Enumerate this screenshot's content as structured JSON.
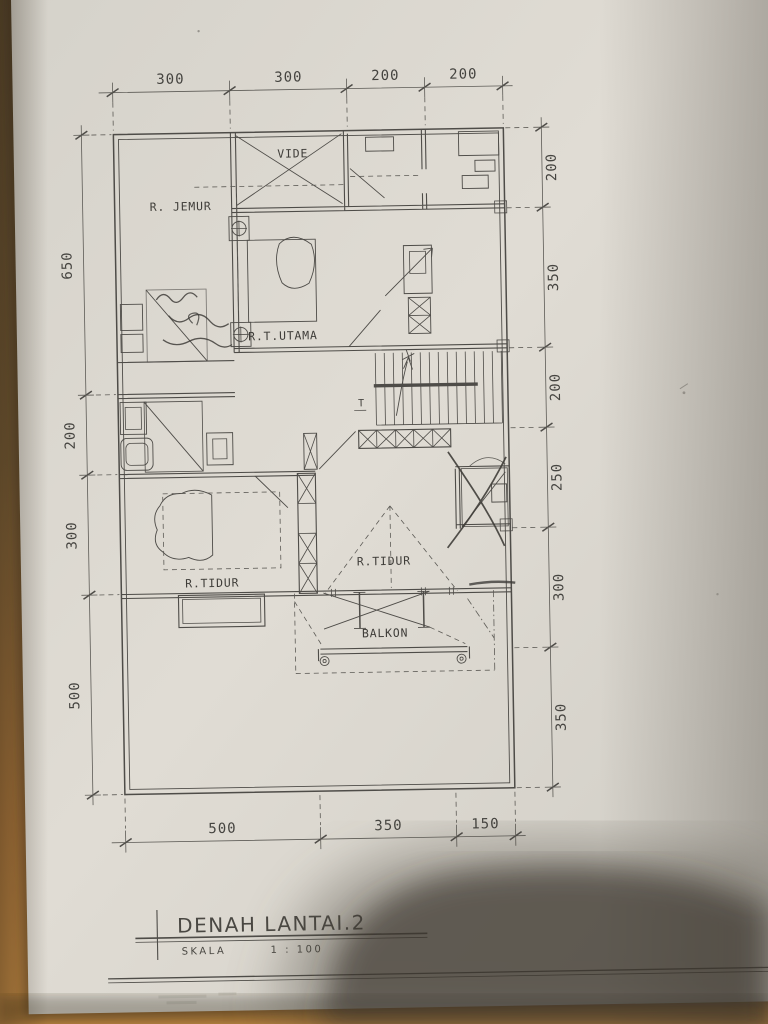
{
  "sheet": {
    "title": "DENAH LANTAI.2",
    "scale_label": "SKALA",
    "scale_value": "1 : 100"
  },
  "rooms": {
    "jemur": "R. JEMUR",
    "vide": "VIDE",
    "utama": "R.T.UTAMA",
    "tidur_left": "R.TIDUR",
    "tidur_center": "R.TIDUR",
    "balkon": "BALKON"
  },
  "annotations": {
    "stair_mark": "T"
  },
  "dimensions": {
    "top": [
      "300",
      "300",
      "200",
      "200"
    ],
    "left": [
      "650",
      "200",
      "300",
      "500"
    ],
    "right": [
      "200",
      "350",
      "200",
      "250",
      "300",
      "350"
    ],
    "bottom": [
      "500",
      "350",
      "150"
    ]
  },
  "colors": {
    "paper": "#dcd8d0",
    "ink": "#4e4c48",
    "wood": "#8a6a3e",
    "wood_bright": "#c88e46",
    "shadow": "#37322b"
  }
}
